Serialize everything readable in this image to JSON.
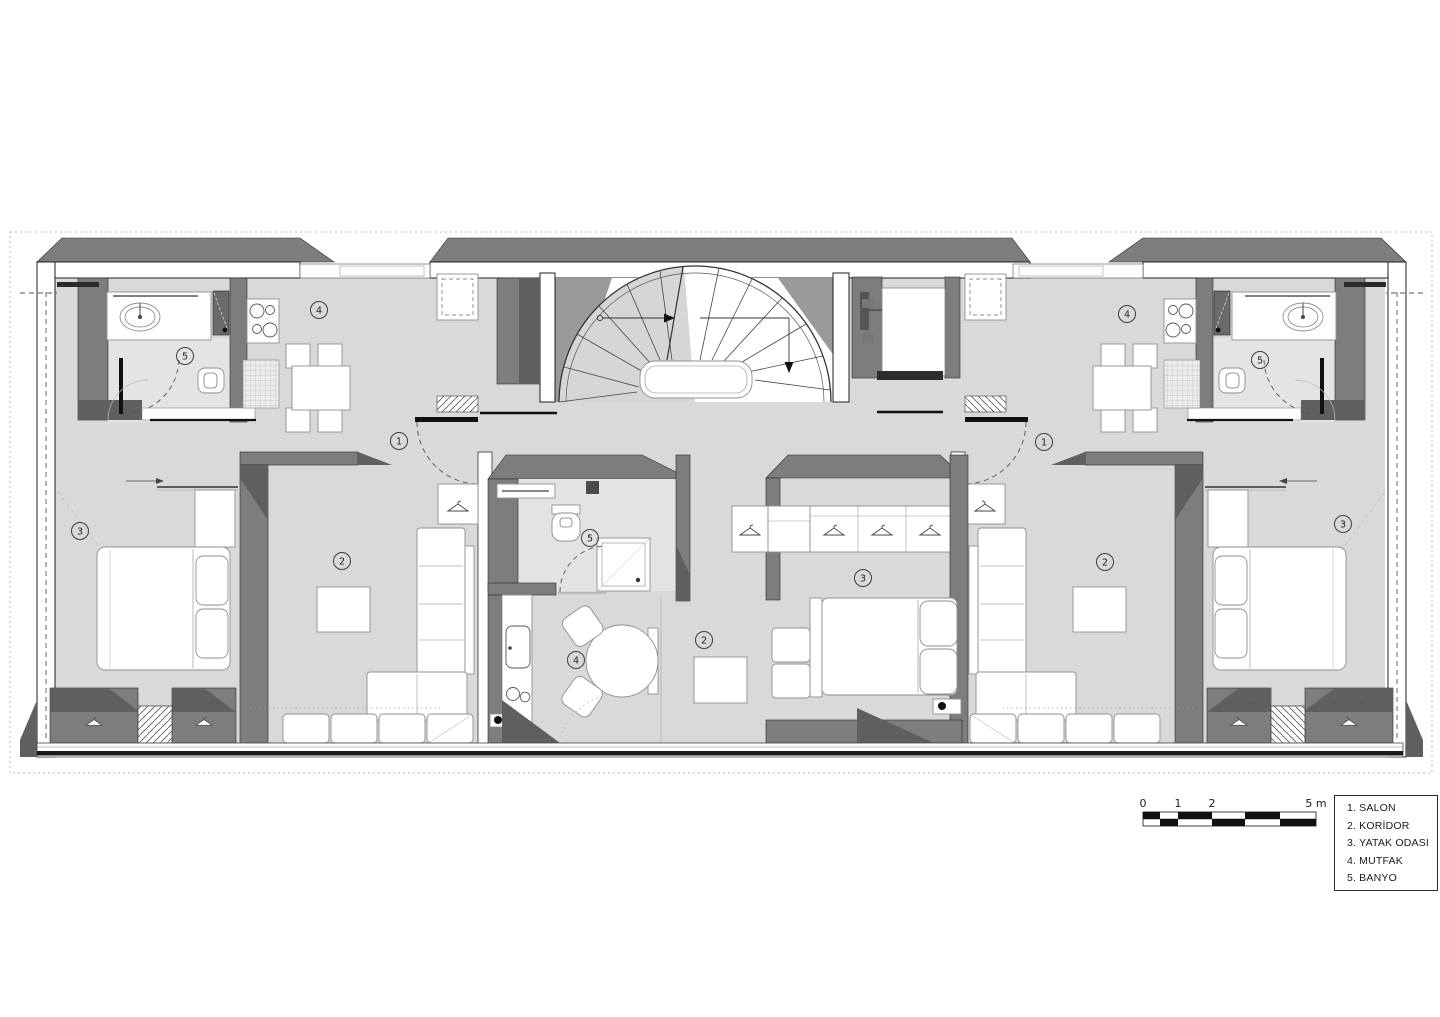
{
  "legend": {
    "items": [
      {
        "num": "1.",
        "label": "SALON"
      },
      {
        "num": "2.",
        "label": "KORİDOR"
      },
      {
        "num": "3.",
        "label": "YATAK ODASI"
      },
      {
        "num": "4.",
        "label": "MUTFAK"
      },
      {
        "num": "5.",
        "label": "BANYO"
      }
    ]
  },
  "scale_bar": {
    "labels": [
      "0",
      "1",
      "2",
      "5 m"
    ]
  },
  "room_markers": [
    {
      "n": "1",
      "x": 399,
      "y": 441
    },
    {
      "n": "1",
      "x": 1044,
      "y": 442
    },
    {
      "n": "2",
      "x": 342,
      "y": 561
    },
    {
      "n": "2",
      "x": 704,
      "y": 640
    },
    {
      "n": "2",
      "x": 1105,
      "y": 562
    },
    {
      "n": "3",
      "x": 80,
      "y": 531
    },
    {
      "n": "3",
      "x": 863,
      "y": 578
    },
    {
      "n": "3",
      "x": 1343,
      "y": 524
    },
    {
      "n": "4",
      "x": 319,
      "y": 310
    },
    {
      "n": "4",
      "x": 576,
      "y": 660
    },
    {
      "n": "4",
      "x": 1127,
      "y": 314
    },
    {
      "n": "5",
      "x": 185,
      "y": 356
    },
    {
      "n": "5",
      "x": 590,
      "y": 538
    },
    {
      "n": "5",
      "x": 1260,
      "y": 360
    }
  ],
  "colors": {
    "wall": "#7d7d7d",
    "wall_shadow": "#5f5f5f",
    "floor": "#d9d9d9",
    "floor_light": "#e4e4e4",
    "line_black": "#111111",
    "paper": "#ffffff"
  }
}
